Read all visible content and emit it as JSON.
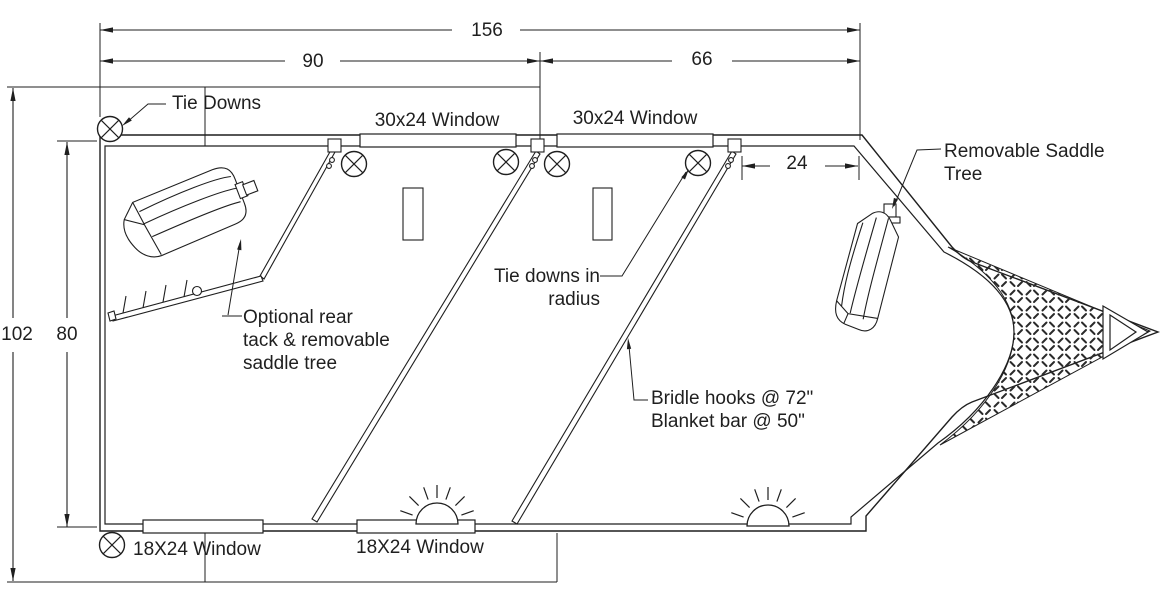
{
  "colors": {
    "ink": "#1f1f1f",
    "background": "#ffffff"
  },
  "dimensions": {
    "overall_length": "156",
    "rear_section_length": "90",
    "front_section_length": "66",
    "overall_width": "102",
    "interior_width": "80",
    "nose_stall_width": "24"
  },
  "labels": {
    "tie_downs": "Tie Downs",
    "top_window_1": "30x24 Window",
    "top_window_2": "30x24 Window",
    "bottom_window_1": "18X24 Window",
    "bottom_window_2": "18X24 Window",
    "removable_saddle_tree": {
      "line1": "Removable Saddle",
      "line2": "Tree"
    },
    "optional_rear_tack": {
      "line1": "Optional rear",
      "line2": "tack & removable",
      "line3": "saddle tree"
    },
    "tie_downs_in_radius": {
      "line1": "Tie downs in",
      "line2": "radius"
    },
    "bridle_hooks": {
      "line1": "Bridle hooks @ 72\"",
      "line2": "Blanket bar @ 50\""
    }
  },
  "symbols": {
    "tie_down_anchor": "circle-x",
    "dome_light": "half-sun-rays",
    "saddle": "saddle-top-view",
    "nose_floor": "diamond-plate",
    "coupler": "nested-triangle"
  }
}
